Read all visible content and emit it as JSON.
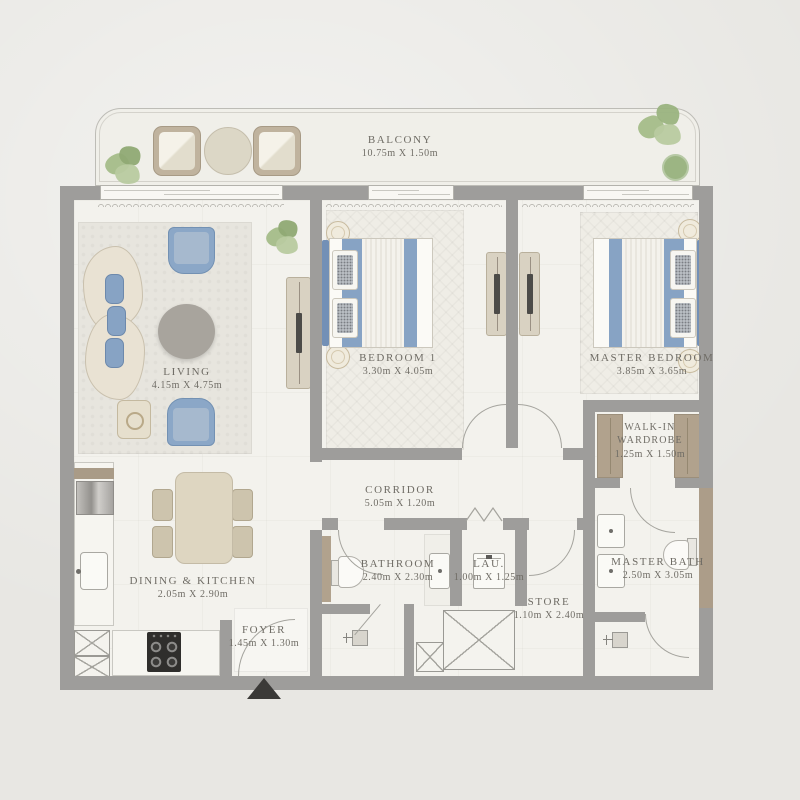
{
  "rooms": {
    "balcony": {
      "name": "BALCONY",
      "dims": "10.75m X 1.50m"
    },
    "living": {
      "name": "LIVING",
      "dims": "4.15m X 4.75m"
    },
    "bedroom1": {
      "name": "BEDROOM 1",
      "dims": "3.30m X 4.05m"
    },
    "master_bedroom": {
      "name": "MASTER BEDROOM",
      "dims": "3.85m X 3.65m"
    },
    "walk_in_wardrobe": {
      "name": "WALK-IN WARDROBE",
      "dims": "1.25m X 1.50m"
    },
    "corridor": {
      "name": "CORRIDOR",
      "dims": "5.05m X 1.20m"
    },
    "dining_kitchen": {
      "name": "DINING & KITCHEN",
      "dims": "2.05m X 2.90m"
    },
    "bathroom": {
      "name": "BATHROOM",
      "dims": "2.40m X 2.30m"
    },
    "laundry": {
      "name": "LAU.",
      "dims": "1.00m X 1.25m"
    },
    "store": {
      "name": "STORE",
      "dims": "1.10m X 2.40m"
    },
    "master_bath": {
      "name": "MASTER BATH",
      "dims": "2.50m X 3.05m"
    },
    "foyer": {
      "name": "FOYER",
      "dims": "1.45m X 1.30m"
    }
  },
  "colors": {
    "wall": "#9e9d9b",
    "floor": "#f3f2ed",
    "accent_blue": "#87a3c4",
    "wood": "#b1a28d",
    "plant_green": "#a4bc89",
    "label_text": "#6f6c65",
    "entry_arrow": "#3b3a38"
  },
  "icons": {
    "entry_arrow": "triangle-up"
  }
}
